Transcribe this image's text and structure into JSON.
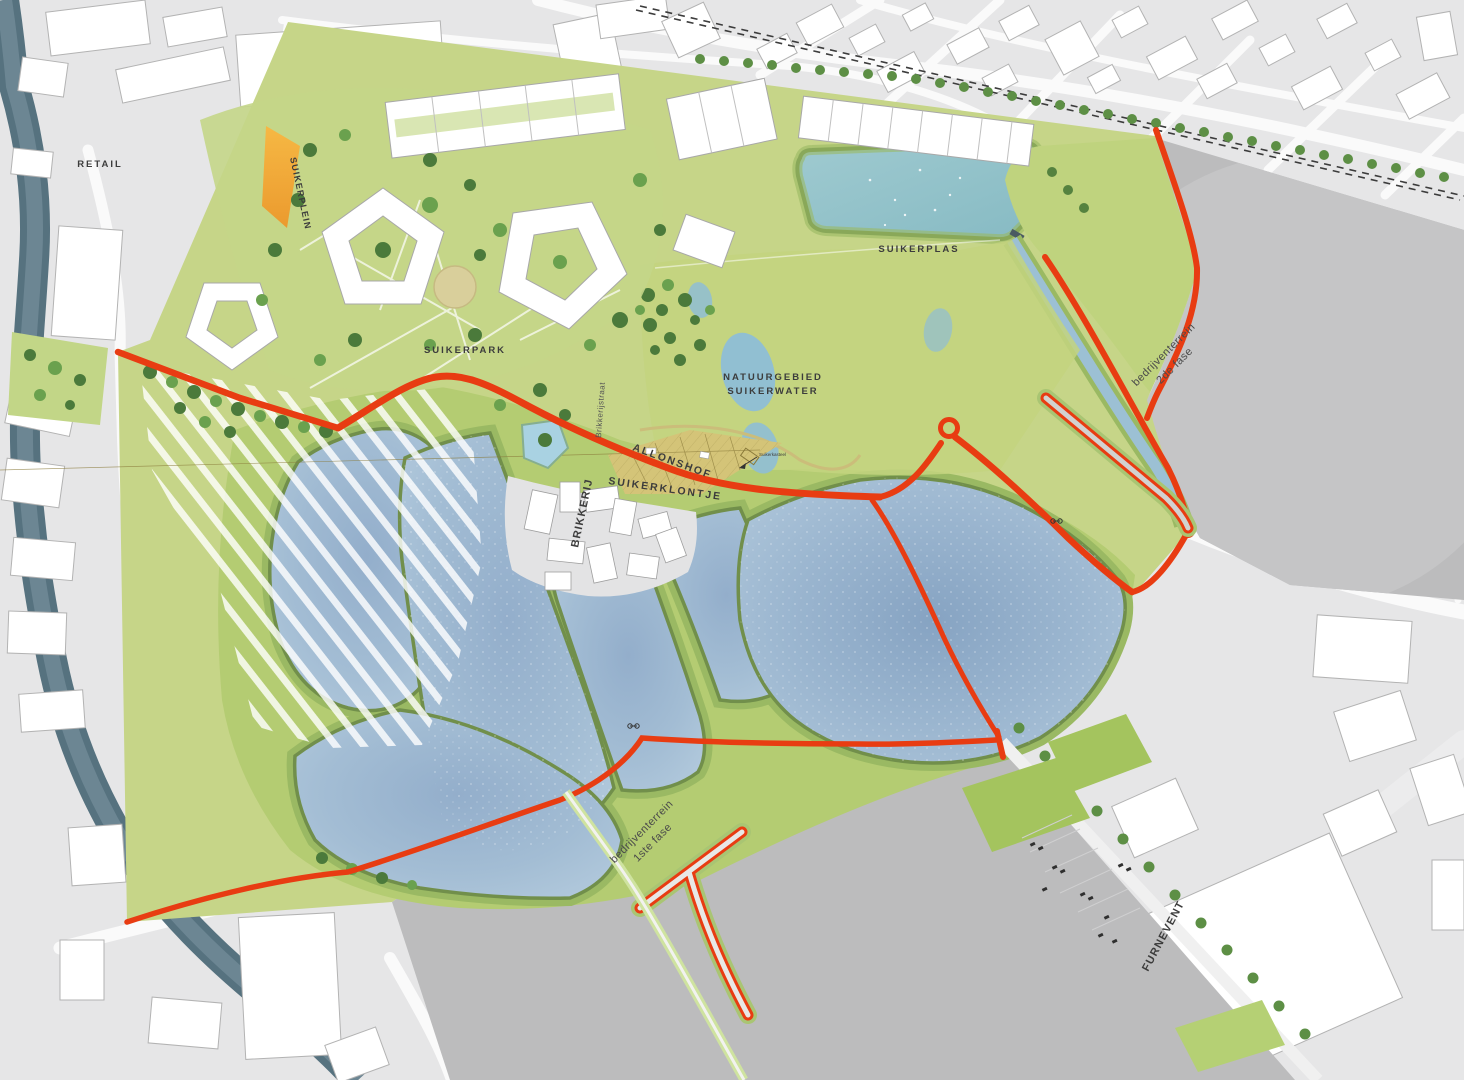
{
  "map": {
    "labels": {
      "retail": "RETAIL",
      "suikerplein": "SUIKERPLEIN",
      "suikerpark": "SUIKERPARK",
      "suikerplas": "SUIKERPLAS",
      "natuurgebied_line1": "NATUURGEBIED",
      "natuurgebied_line2": "SUIKERWATER",
      "allonshof": "ALLONSHOF",
      "suikerklontje": "SUIKERKLONTJE",
      "brikkerijstraat": "Brikkerijstraat",
      "brikkerij": "BRIKKERIJ",
      "bedrijventerrein2_line1": "bedrijventerrein",
      "bedrijventerrein2_line2": "2de fase",
      "bedrijventerrein1_line1": "bedrijventerrein",
      "bedrijventerrein1_line2": "1ste fase",
      "furnevent": "FURNEVENT",
      "annotation_suikerkasteel": "Suikerkasteel"
    },
    "colors": {
      "city_background": "#e6e6e7",
      "building_white": "#ffffff",
      "industrial_gray": "#bcbcbd",
      "site_green": "#c6d588",
      "embankment_green": "#b4cc72",
      "bank_edge_green": "#718f4b",
      "water_blue": "#9db9d1",
      "plas_teal": "#93c3ca",
      "river_slate": "#56727f",
      "route_red": "#e83c12",
      "allotment_tan": "#d4c478",
      "accent_orange": "#f2a93c",
      "tree_green": "#55823f",
      "label_text": "#3c3c3c"
    }
  }
}
